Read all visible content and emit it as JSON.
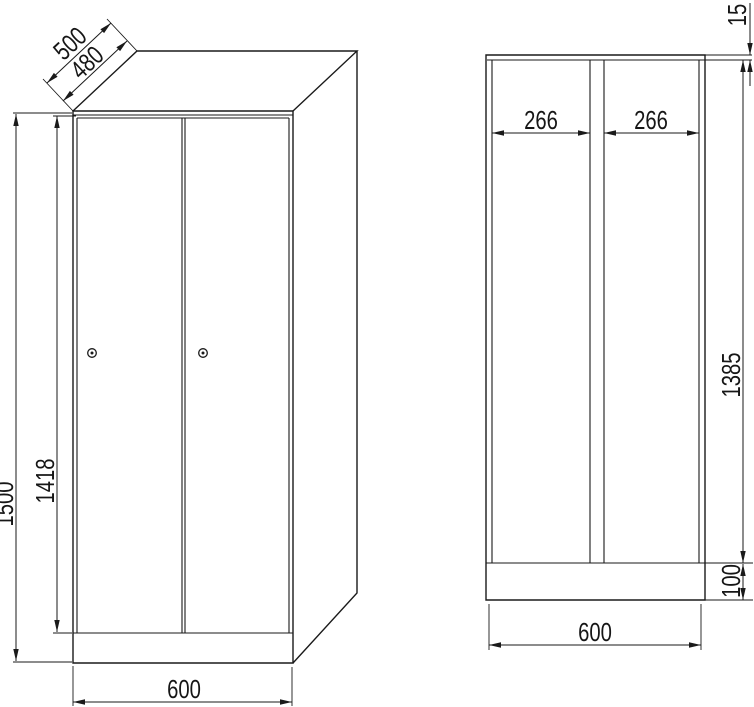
{
  "drawing": {
    "kind": "technical-dimension-drawing",
    "subject": "two-door locker cabinet, perspective view and front section view",
    "line_color": "#1a1a1a",
    "background_color": "#ffffff",
    "perspective_view": {
      "depth_outer": "500",
      "depth_inner": "480",
      "height_total": "1500",
      "door_height": "1418",
      "width_total": "600"
    },
    "section_view": {
      "compartment_width_left": "266",
      "compartment_width_right": "266",
      "top_panel_thickness": "15",
      "interior_height": "1385",
      "plinth_height": "100",
      "width_total": "600"
    }
  }
}
